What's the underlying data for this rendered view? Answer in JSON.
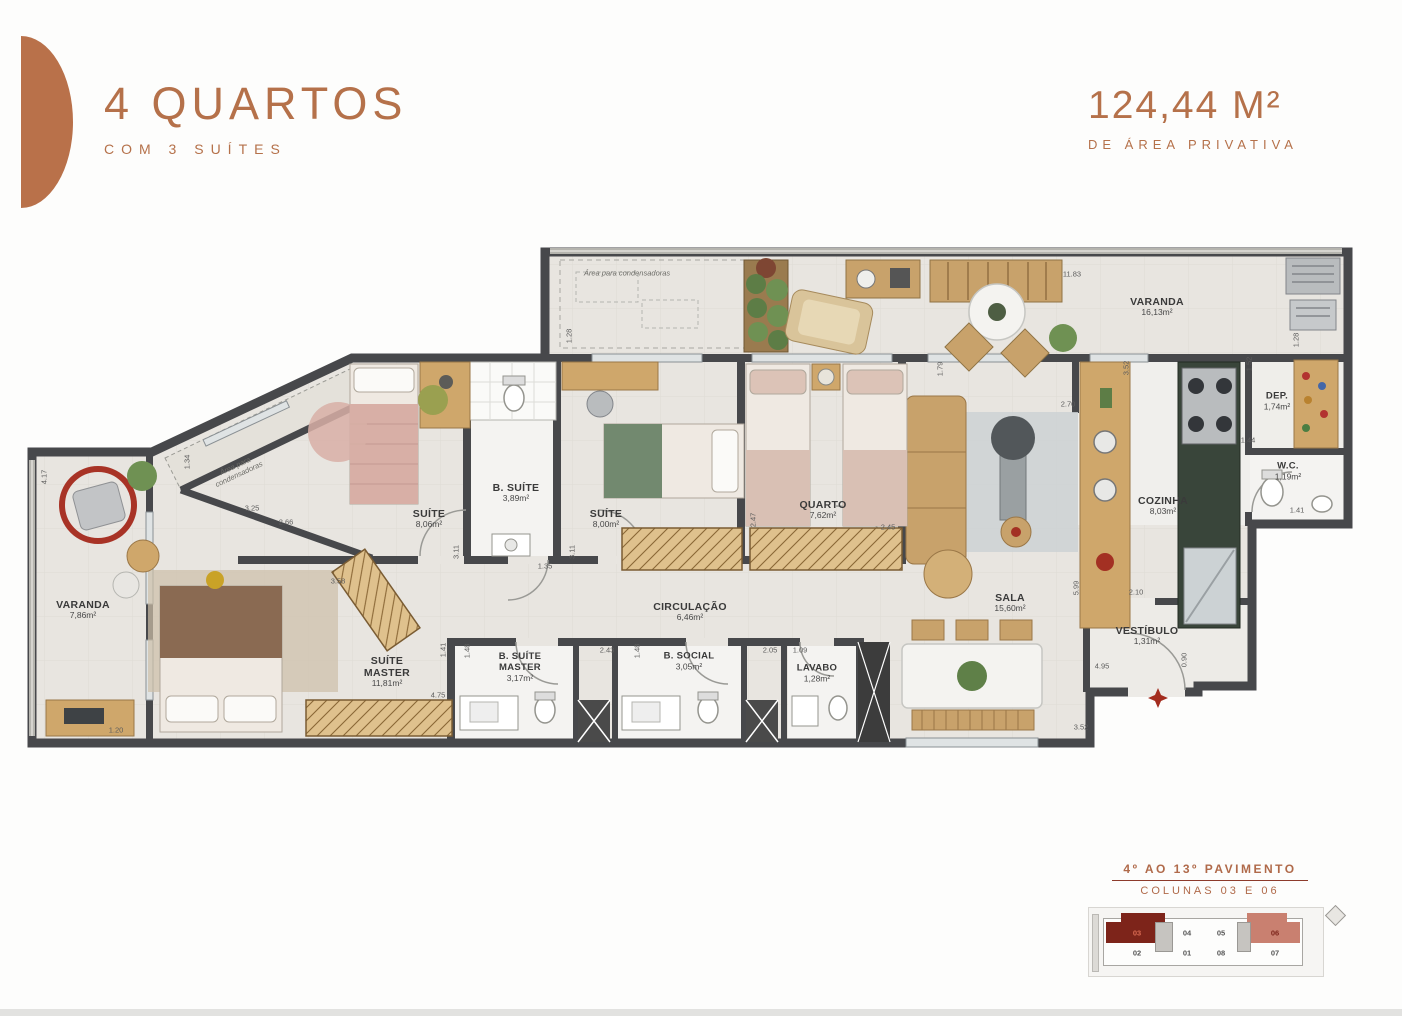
{
  "header": {
    "title": "4 QUARTOS",
    "subtitle": "COM 3 SUÍTES",
    "area_value": "124,44 M²",
    "area_label": "DE ÁREA PRIVATIVA",
    "accent_color": "#b5714a"
  },
  "plan": {
    "note": "Área para condensadoras",
    "rooms": [
      {
        "name": "VARANDA",
        "area": "16,13m²"
      },
      {
        "name": "DEP.",
        "area": "1,74m²"
      },
      {
        "name": "W.C.",
        "area": "1,19m²"
      },
      {
        "name": "COZINHA",
        "area": "8,03m²"
      },
      {
        "name": "VESTÍBULO",
        "area": "1,31m²"
      },
      {
        "name": "SALA",
        "area": "15,60m²"
      },
      {
        "name": "QUARTO",
        "area": "7,62m²"
      },
      {
        "name": "SUÍTE",
        "area": "8,00m²"
      },
      {
        "name": "B. SUÍTE",
        "area": "3,89m²"
      },
      {
        "name": "SUÍTE",
        "area": "8,06m²"
      },
      {
        "name": "SUÍTE MASTER",
        "area": "11,81m²"
      },
      {
        "name": "B. SUÍTE MASTER",
        "area": "3,17m²"
      },
      {
        "name": "B. SOCIAL",
        "area": "3,05m²"
      },
      {
        "name": "LAVABO",
        "area": "1,28m²"
      },
      {
        "name": "VARANDA",
        "area": "7,86m²"
      },
      {
        "name": "CIRCULAÇÃO",
        "area": "6,46m²"
      }
    ],
    "dims": [
      "11.83",
      "1.28",
      "1.79",
      "3.52",
      "2.70",
      "1.52",
      "1.28",
      "1.44",
      "1.41",
      "2.10",
      "0.90",
      "4.95",
      "3.52",
      "2.45",
      "2.47",
      "1.35",
      "3.11",
      "3.11",
      "2.66",
      "3.25",
      "4.17",
      "1.34",
      "3.58",
      "4.75",
      "1.20",
      "1.48",
      "2.43",
      "1.48",
      "2.05",
      "1.09",
      "5.99",
      "1.41"
    ],
    "colors": {
      "wall": "#47484b",
      "floor": "#e8e5e0",
      "wood": "#c8a26b",
      "marble": "#39453a",
      "accent_red": "#a32c1e"
    }
  },
  "legend": {
    "line1": "4º AO 13º PAVIMENTO",
    "line2": "COLUNAS 03 E 06",
    "units_top": [
      "03",
      "04",
      "05",
      "06"
    ],
    "units_bottom": [
      "02",
      "01",
      "08",
      "07"
    ],
    "highlight_dark": "#7d241a",
    "highlight_light": "#c98070"
  }
}
